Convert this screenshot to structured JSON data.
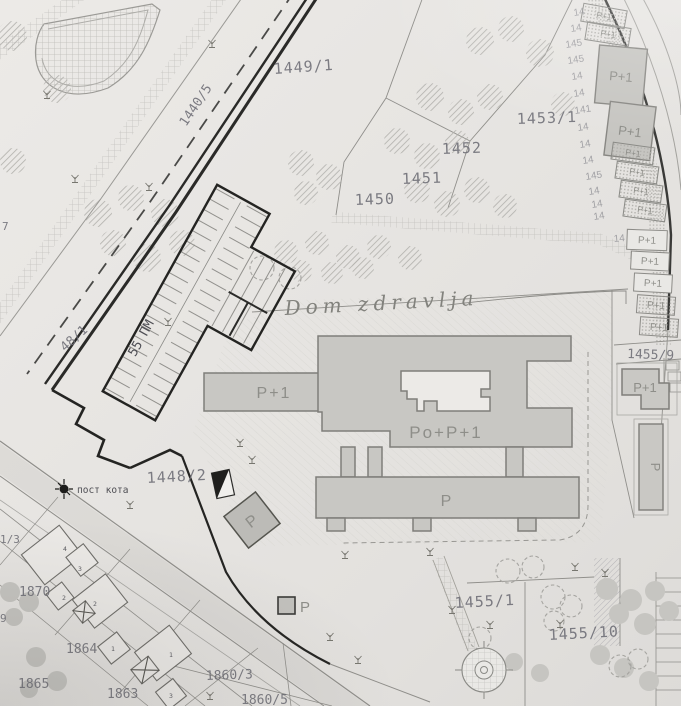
{
  "document": {
    "kind": "scanned cadastral site plan",
    "site_name": "Dom zdravlja"
  },
  "colors": {
    "paper": "#e7e5e2",
    "building_fill": "#c8c7c3",
    "building_stroke": "#7f7e7a",
    "heavy_line": "#262624",
    "pencil_text": "#6d6d75",
    "storey_text": "#8e8e89"
  },
  "annotations": {
    "site_name": "Dom zdravlja",
    "parking_capacity": "55 ПМ",
    "elevation_point": "пост кота",
    "parking_symbol": "P"
  },
  "parcels": {
    "r1449_1": "1449/1",
    "r1440_5": "1440/5",
    "r1450": "1450",
    "r1451": "1451",
    "r1452": "1452",
    "r1453_1": "1453/1",
    "r48_1": "48/1",
    "r1448_2": "1448/2",
    "r7": "7",
    "r1_3": "1/3",
    "r9": "9",
    "r1870": "1870",
    "r1864": "1864",
    "r1865": "1865",
    "r1863": "1863",
    "r1860_3": "1860/3",
    "r1860_5": "1860/5",
    "r1455_9": "1455/9",
    "r1455_1": "1455/1",
    "r1455_10": "1455/10"
  },
  "storeys": {
    "p1": "P+1",
    "po_p1": "Po+P+1",
    "p": "P"
  },
  "fragments": [
    "14",
    "14",
    "145",
    "145",
    "14",
    "14",
    "141",
    "14",
    "14",
    "14",
    "145",
    "14",
    "14",
    "14",
    "14"
  ],
  "houses": [
    "4",
    "3",
    "2",
    "2",
    "1",
    "1",
    "3"
  ]
}
